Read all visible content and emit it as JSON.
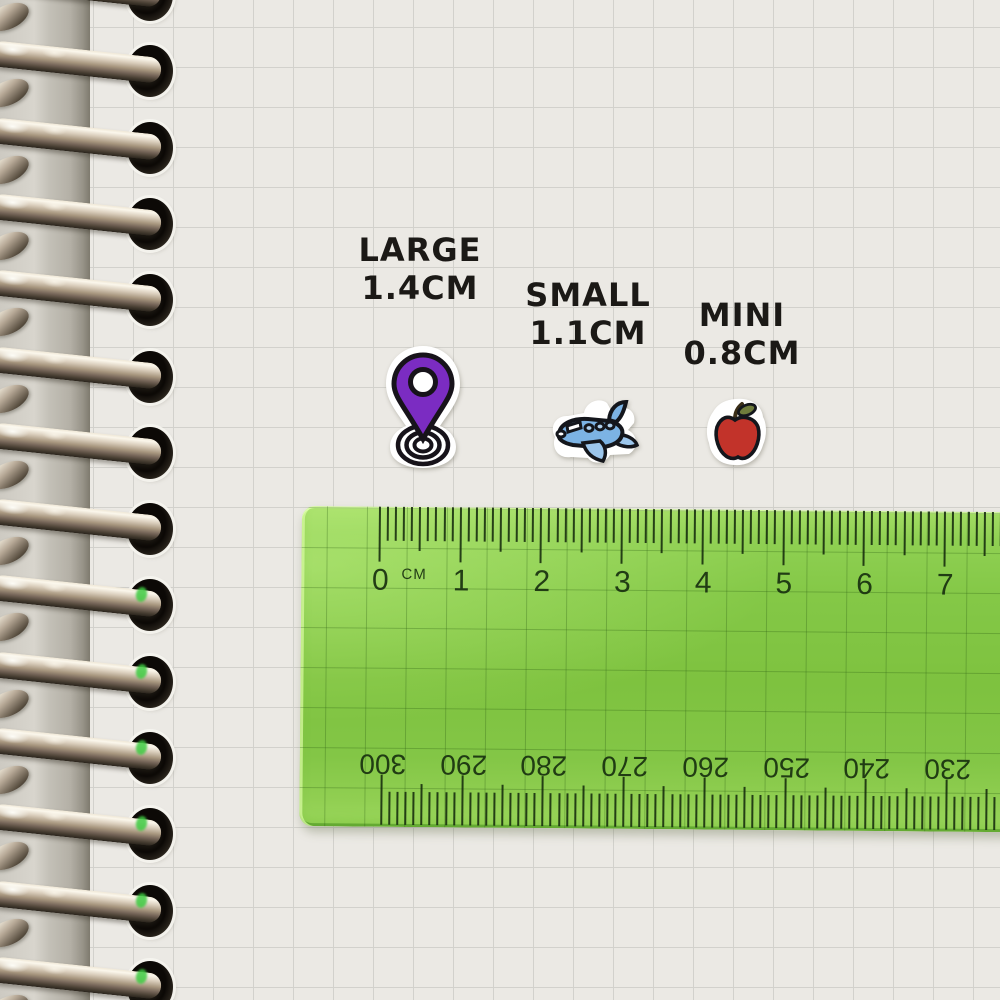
{
  "labels": {
    "large": {
      "name": "LARGE",
      "size": "1.4CM"
    },
    "small": {
      "name": "SMALL",
      "size": "1.1CM"
    },
    "mini": {
      "name": "MINI",
      "size": "0.8CM"
    }
  },
  "stickers": [
    {
      "id": "location-pin-sticker",
      "icon": "location-pin-icon",
      "color": "#7b2cc2"
    },
    {
      "id": "airplane-sticker",
      "icon": "airplane-icon",
      "color": "#7cb3e4"
    },
    {
      "id": "apple-sticker",
      "icon": "apple-icon",
      "color": "#c2332a"
    }
  ],
  "ruler": {
    "unit_label": "CM",
    "top_numbers": [
      "0",
      "1",
      "2",
      "3",
      "4",
      "5",
      "6",
      "7"
    ],
    "bottom_numbers": [
      "300",
      "290",
      "280",
      "270",
      "260",
      "250",
      "240",
      "230"
    ],
    "body_color": "#84c847",
    "tick_color": "#142a0c"
  }
}
